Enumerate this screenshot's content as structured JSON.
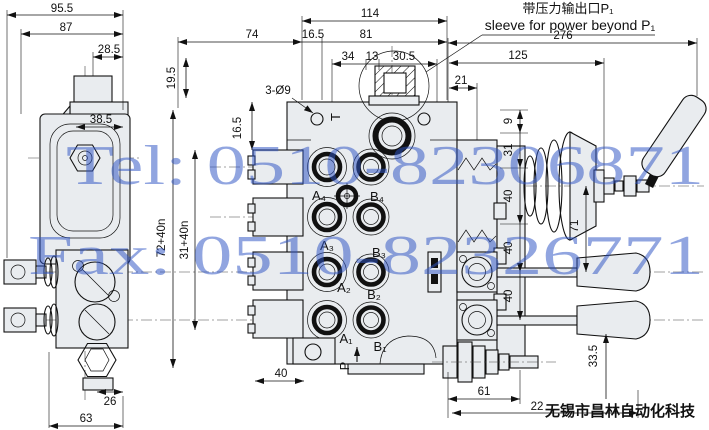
{
  "meta": {
    "background": "#ffffff",
    "line_color": "#111111",
    "metal_fill": "#e9ecef",
    "watermark_color": "#2e54c4"
  },
  "watermark": {
    "tel": "Tel: 0510-82306871",
    "fax": "Fax: 0510-82326771"
  },
  "company": "无锡市昌林自动化科技",
  "callout": {
    "cn": "带压力输出口P₁",
    "en": "sleeve for power beyond P₁"
  },
  "labels": {
    "holes": "3-Ø9"
  },
  "ports": {
    "t": "T",
    "p": "P",
    "a4": "A₄",
    "b4": "B₄",
    "a3": "A₃",
    "b3": "B₃",
    "a2": "A₂",
    "b2": "B₂",
    "a1": "A₁",
    "b1": "B₁"
  },
  "dims": {
    "d955": "95.5",
    "d87": "87",
    "d285": "28.5",
    "d385": "38.5",
    "d26": "26",
    "d63": "63",
    "d195": "19.5",
    "d165v": "16.5",
    "d72n": "72+40n",
    "d31n": "31+40n",
    "d114": "114",
    "d74": "74",
    "d165": "16.5",
    "d81": "81",
    "d34": "34",
    "d13": "13",
    "d305": "30.5",
    "d276": "276",
    "d125": "125",
    "d21": "21",
    "d9": "9",
    "d31": "31",
    "d40a": "40",
    "d40b": "40",
    "d40c": "40",
    "d71": "71",
    "d335": "33.5",
    "d40p": "40",
    "d61": "61",
    "d22": "22"
  }
}
